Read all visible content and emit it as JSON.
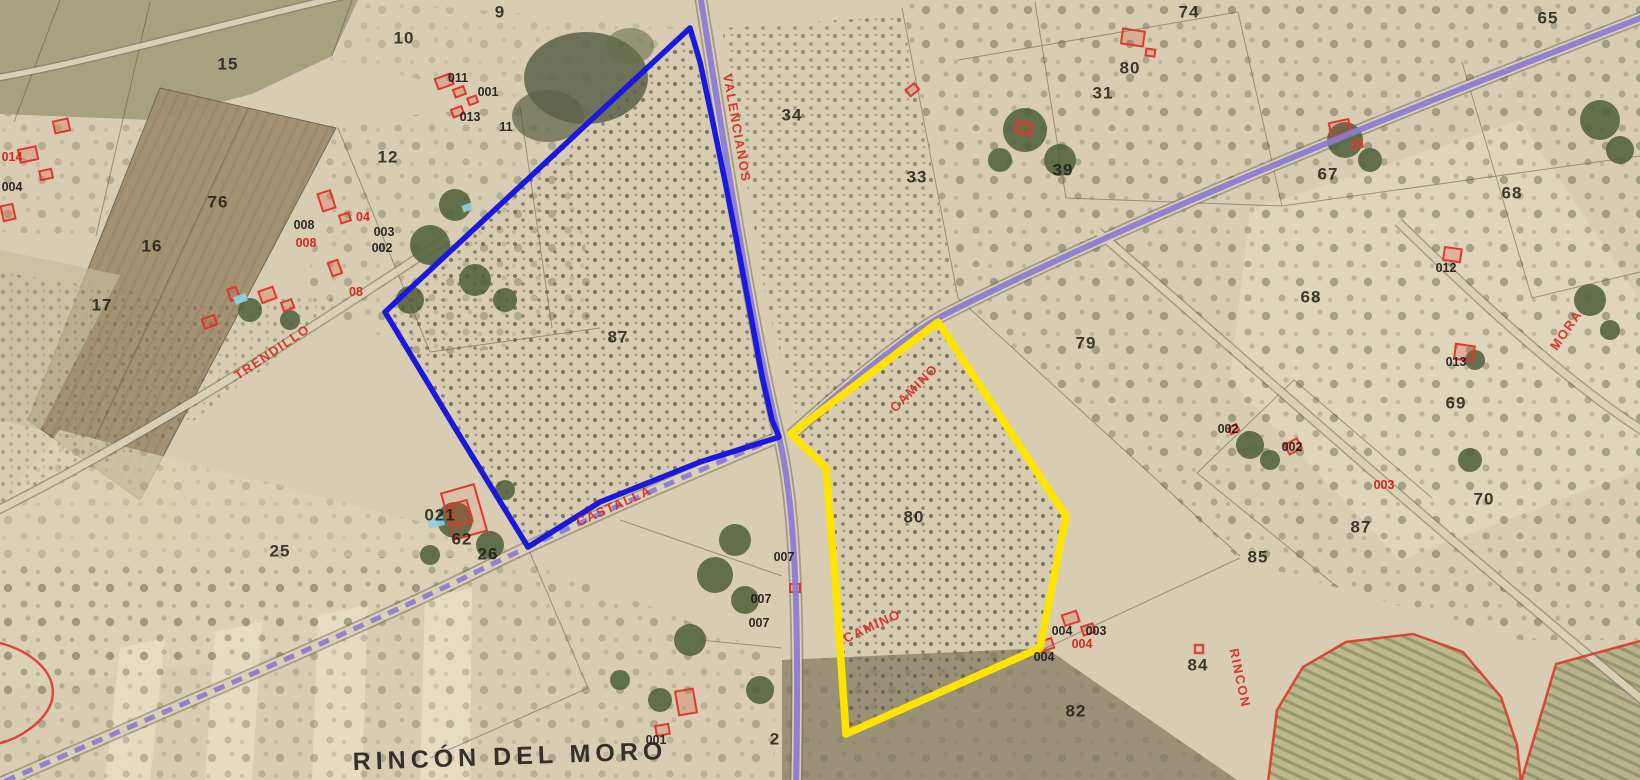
{
  "map": {
    "type": "cadastral-aerial-overlay",
    "selected_parcels": [
      {
        "outline": "blue",
        "parcel_number": "87"
      },
      {
        "outline": "yellow",
        "parcel_number": "80"
      }
    ],
    "colors": {
      "terrain_tan": "#d8cdb2",
      "selected_parcel_blue": "#1b18dc",
      "selected_parcel_yellow": "#ffe400",
      "route_purple": "#8b7ad4",
      "cadastral_red": "#dd3a2a"
    },
    "labels": [
      {
        "kind": "road",
        "text": "VALENCIANOS",
        "x": 737,
        "y": 128,
        "rot": 80
      },
      {
        "kind": "road",
        "text": "CAMINO",
        "x": 914,
        "y": 388,
        "rot": -45
      },
      {
        "kind": "road",
        "text": "CAMINO",
        "x": 872,
        "y": 626,
        "rot": -25
      },
      {
        "kind": "road",
        "text": "CASTALLA",
        "x": 614,
        "y": 506,
        "rot": -24
      },
      {
        "kind": "road",
        "text": "TRENDILLO",
        "x": 272,
        "y": 352,
        "rot": -34
      },
      {
        "kind": "road",
        "text": "MORA",
        "x": 1566,
        "y": 330,
        "rot": -55
      },
      {
        "kind": "road",
        "text": "RINCON",
        "x": 1240,
        "y": 678,
        "rot": 78
      },
      {
        "kind": "place",
        "text": "RINCÓN DEL MORO",
        "x": 510,
        "y": 757,
        "rot": -2
      },
      {
        "kind": "parcel",
        "text": "9",
        "x": 500,
        "y": 12
      },
      {
        "kind": "parcel",
        "text": "15",
        "x": 228,
        "y": 64
      },
      {
        "kind": "parcel",
        "text": "10",
        "x": 404,
        "y": 38
      },
      {
        "kind": "parcel",
        "text": "74",
        "x": 1189,
        "y": 12
      },
      {
        "kind": "parcel",
        "text": "65",
        "x": 1548,
        "y": 18
      },
      {
        "kind": "parcel",
        "text": "80",
        "x": 1130,
        "y": 68
      },
      {
        "kind": "parcel",
        "text": "31",
        "x": 1103,
        "y": 93
      },
      {
        "kind": "parcel",
        "text": "34",
        "x": 792,
        "y": 115
      },
      {
        "kind": "parcel",
        "text": "33",
        "x": 917,
        "y": 177
      },
      {
        "kind": "parcel",
        "text": "39",
        "x": 1063,
        "y": 170
      },
      {
        "kind": "parcel",
        "text": "67",
        "x": 1328,
        "y": 174
      },
      {
        "kind": "parcel",
        "text": "12",
        "x": 388,
        "y": 157
      },
      {
        "kind": "parcel",
        "text": "76",
        "x": 218,
        "y": 202
      },
      {
        "kind": "parcel",
        "text": "16",
        "x": 152,
        "y": 246
      },
      {
        "kind": "parcel",
        "text": "17",
        "x": 102,
        "y": 305
      },
      {
        "kind": "parcel",
        "text": "68",
        "x": 1512,
        "y": 193
      },
      {
        "kind": "parcel",
        "text": "68",
        "x": 1311,
        "y": 297
      },
      {
        "kind": "parcel",
        "text": "69",
        "x": 1456,
        "y": 403
      },
      {
        "kind": "parcel",
        "text": "87",
        "x": 618,
        "y": 337
      },
      {
        "kind": "parcel",
        "text": "79",
        "x": 1086,
        "y": 343
      },
      {
        "kind": "parcel",
        "text": "80",
        "x": 914,
        "y": 517
      },
      {
        "kind": "parcel",
        "text": "25",
        "x": 280,
        "y": 551
      },
      {
        "kind": "parcel",
        "text": "62",
        "x": 462,
        "y": 539
      },
      {
        "kind": "parcel",
        "text": "26",
        "x": 488,
        "y": 554
      },
      {
        "kind": "parcel",
        "text": "2",
        "x": 775,
        "y": 739
      },
      {
        "kind": "parcel",
        "text": "85",
        "x": 1258,
        "y": 557
      },
      {
        "kind": "parcel",
        "text": "87",
        "x": 1361,
        "y": 527
      },
      {
        "kind": "parcel",
        "text": "84",
        "x": 1198,
        "y": 665
      },
      {
        "kind": "parcel",
        "text": "82",
        "x": 1076,
        "y": 711
      },
      {
        "kind": "parcel",
        "text": "70",
        "x": 1484,
        "y": 499
      },
      {
        "kind": "parcel",
        "text": "021",
        "x": 440,
        "y": 515
      },
      {
        "kind": "bnum",
        "text": "011",
        "x": 458,
        "y": 78
      },
      {
        "kind": "bnum",
        "text": "001",
        "x": 488,
        "y": 92
      },
      {
        "kind": "bnum",
        "text": "013",
        "x": 470,
        "y": 117
      },
      {
        "kind": "bnum",
        "text": "11",
        "x": 506,
        "y": 127
      },
      {
        "kind": "bnum",
        "text": "004",
        "x": 12,
        "y": 187
      },
      {
        "kind": "bnum",
        "text": "008",
        "x": 304,
        "y": 225
      },
      {
        "kind": "bnum",
        "text": "003",
        "x": 384,
        "y": 232
      },
      {
        "kind": "bnum",
        "text": "002",
        "x": 382,
        "y": 248
      },
      {
        "kind": "bnum",
        "text": "007",
        "x": 784,
        "y": 557
      },
      {
        "kind": "bnum",
        "text": "007",
        "x": 761,
        "y": 599
      },
      {
        "kind": "bnum",
        "text": "007",
        "x": 759,
        "y": 623
      },
      {
        "kind": "bnum",
        "text": "001",
        "x": 656,
        "y": 740
      },
      {
        "kind": "bnum",
        "text": "002",
        "x": 1292,
        "y": 447
      },
      {
        "kind": "bnum",
        "text": "002",
        "x": 1228,
        "y": 429
      },
      {
        "kind": "bnum",
        "text": "012",
        "x": 1446,
        "y": 268
      },
      {
        "kind": "bnum",
        "text": "013",
        "x": 1456,
        "y": 362
      },
      {
        "kind": "bnum",
        "text": "004",
        "x": 1062,
        "y": 631
      },
      {
        "kind": "bnum",
        "text": "003",
        "x": 1096,
        "y": 631
      },
      {
        "kind": "bnum",
        "text": "004",
        "x": 1044,
        "y": 657
      },
      {
        "kind": "bnum-red",
        "text": "014",
        "x": 12,
        "y": 157
      },
      {
        "kind": "bnum-red",
        "text": "008",
        "x": 306,
        "y": 243
      },
      {
        "kind": "bnum-red",
        "text": "08",
        "x": 356,
        "y": 292
      },
      {
        "kind": "bnum-red",
        "text": "04",
        "x": 363,
        "y": 217
      },
      {
        "kind": "bnum-red",
        "text": "004",
        "x": 1082,
        "y": 644
      },
      {
        "kind": "bnum-red",
        "text": "003",
        "x": 1384,
        "y": 485
      }
    ]
  }
}
